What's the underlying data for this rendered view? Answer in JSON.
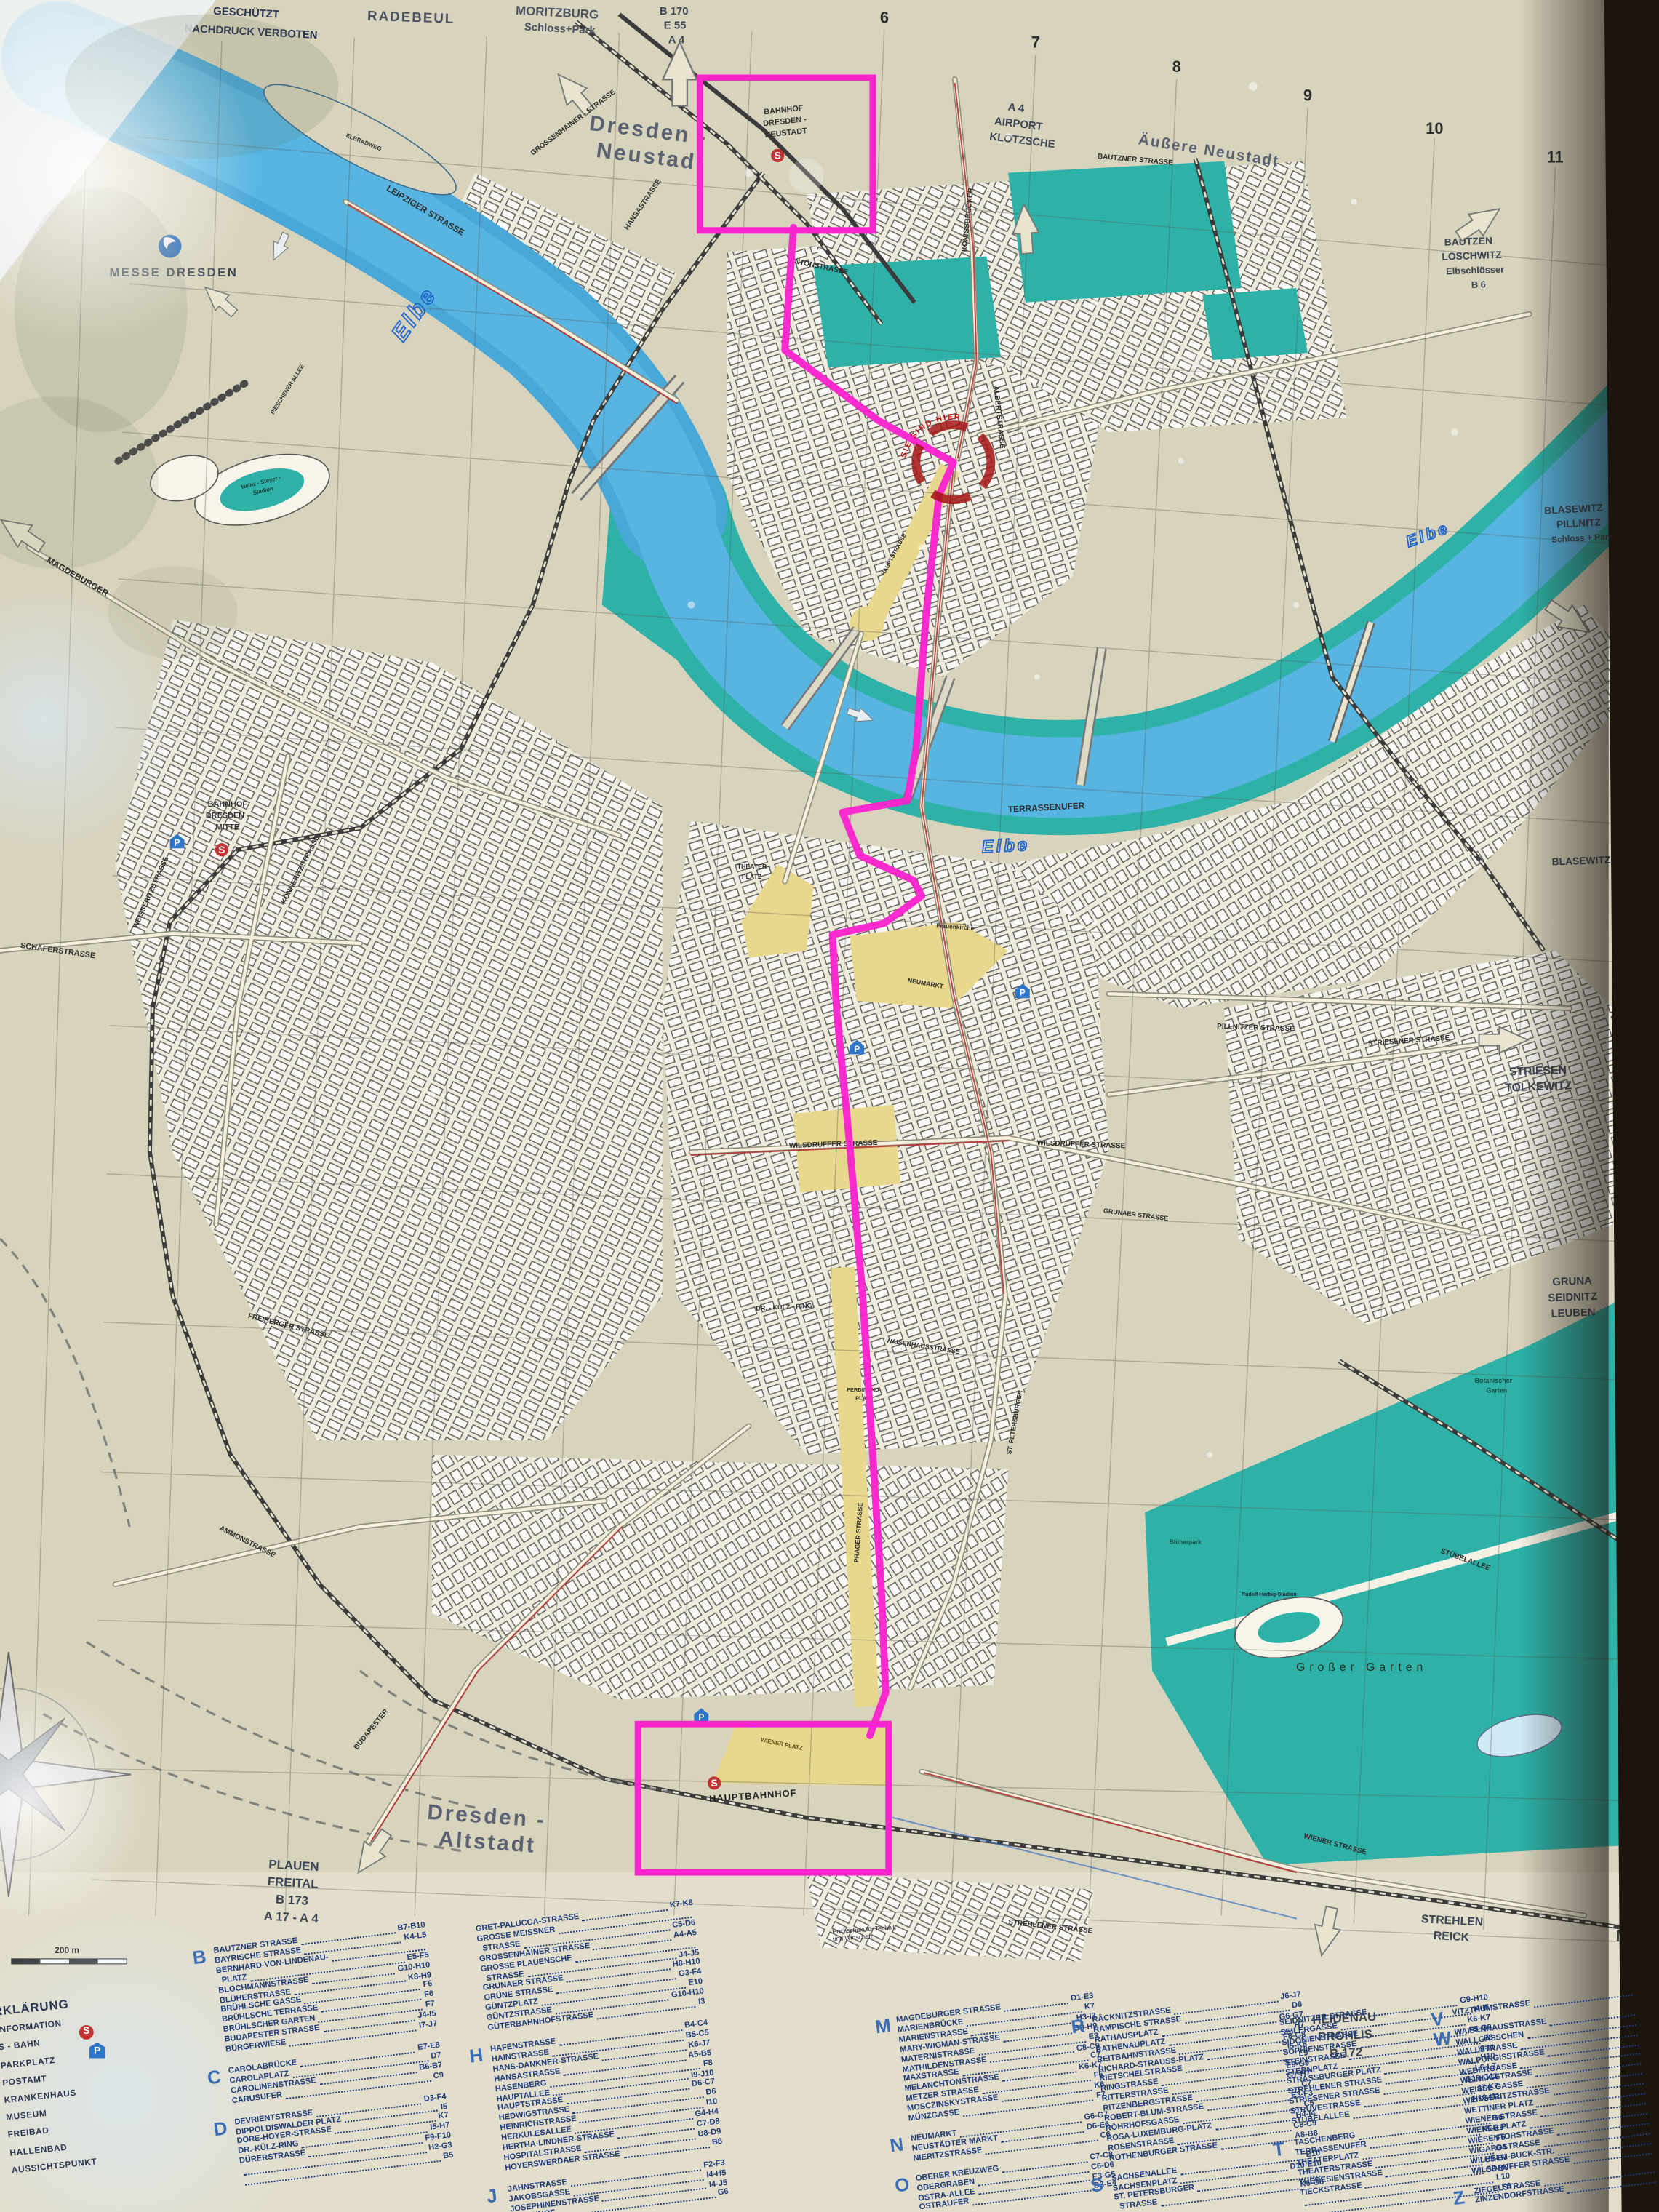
{
  "notice": {
    "line1": "GESCHÜTZT",
    "line2": "NACHDRUCK VERBOTEN"
  },
  "grid": {
    "cols": [
      "6",
      "7",
      "8",
      "9",
      "10",
      "11"
    ],
    "rows": [
      "A",
      "B",
      "C",
      "D",
      "E",
      "F",
      "G",
      "H",
      "I",
      "J",
      "K",
      "L",
      "M"
    ]
  },
  "edge": {
    "radebeul": "RADEBEUL",
    "moritzburg1": "MORITZBURG",
    "moritzburg2": "Schloss+Park",
    "b170": "B 170",
    "e55": "E 55",
    "a4": "A 4",
    "airport1": "A 4",
    "airport2": "AIRPORT",
    "airport3": "KLOTZSCHE",
    "bautzen1": "BAUTZEN",
    "bautzen2": "LOSCHWITZ",
    "bautzen3": "Elbschlösser",
    "bautzen4": "B 6",
    "blasewitz1": "BLASEWITZ",
    "blasewitz2": "PILLNITZ",
    "blasewitz3": "Schloss + Park",
    "blasewitz_single": "BLASEWITZ",
    "striesen1": "STRIESEN",
    "striesen2": "TOLKEWITZ",
    "gruna1": "GRUNA",
    "gruna2": "SEIDNITZ",
    "gruna3": "LEUBEN",
    "strehlen1": "STREHLEN",
    "strehlen2": "REICK",
    "heidenau1": "HEIDENAU",
    "heidenau2": "PROHLIS",
    "heidenau3": "B 172",
    "plauen1": "PLAUEN",
    "plauen2": "FREITAL",
    "plauen3": "B 173",
    "plauen4": "A 17 - A 4"
  },
  "districts": {
    "dresden_neustadt1": "Dresden -",
    "dresden_neustadt2": "Neustadt",
    "aeussere_neustadt": "Äußere Neustadt",
    "dresden_altstadt1": "Dresden -",
    "dresden_altstadt2": "Altstadt"
  },
  "stations": {
    "neustadt1": "BAHNHOF",
    "neustadt2": "DRESDEN -",
    "neustadt3": "NEUSTADT",
    "mitte1": "BAHNHOF",
    "mitte2": "DRESDEN -",
    "mitte3": "MITTE",
    "hbf": "HAUPTBAHNHOF",
    "s": "S",
    "p": "P"
  },
  "landmarks": {
    "messe": "MESSE DRESDEN",
    "heinz1": "Heinz - Steyer -",
    "heinz2": "Stadion",
    "grosser_garten": "Großer   Garten",
    "botanischer1": "Botanischer",
    "botanischer2": "Garten",
    "bluherpark": "Blüherpark",
    "harbig": "Rudolf-Harbig-Stadion",
    "frauenkirche": "Frauenkirche",
    "theaterplatz1": "THEATER -",
    "theaterplatz2": "PLATZ",
    "neumarkt": "NEUMARKT",
    "wiener_platz": "WIENER  PLATZ",
    "ferdinand1": "FERDINAND-",
    "ferdinand2": "PLATZ",
    "sie_sind_hier": "SIE SIND HIER"
  },
  "hochschule": {
    "line1": "Hochschule für Technik",
    "line2": "und Wirtschaft"
  },
  "river": {
    "elbe": "Elbe"
  },
  "streets": {
    "leipziger": "LEIPZIGER  STRASSE",
    "grossenhainer": "GROSSENHAINER - STRASSE",
    "hansastrasse": "HANSASTRASSE",
    "koenigsbruecker": "KÖNIGSBRÜCKER",
    "antonstrasse": "ANTONSTRASSE",
    "bautzner": "BAUTZNER  STRASSE",
    "albertstrasse": "ALBERTSTRASSE",
    "terrassenufer": "TERRASSENUFER",
    "wilsdruffer": "WILSDRUFFER  STRASSE",
    "dr_kuelz": "DR. - KÜLZ - RING",
    "waisenhaus": "WAISENHAUSSTRASSE",
    "pillnitzer": "PILLNITZER  STRASSE",
    "striesener": "STRIESENER  STRASSE",
    "stuebelallee": "STÜBELALLEE",
    "wiener": "WIENER  STRASSE",
    "strehlener": "STREHLENER  STRASSE",
    "budapester": "BUDAPESTER",
    "magdeburger": "MAGDEBURGER",
    "schaefer": "SCHÄFERSTRASSE",
    "weisseritz": "WEISSERITZSTRASSE",
    "koenneritz": "KÖNNERITZSTRASSE",
    "ammon": "AMMONSTRASSE",
    "freiberger": "FREIBERGER  STRASSE",
    "elbradweg": "ELBRADWEG",
    "pieschener": "PIESCHENER  ALLEE",
    "st_petersburger": "ST. PETERSBURGER",
    "prager": "PRAGER  STRASSE",
    "hauptstrasse": "HAUPTSTRASSE",
    "grunaer": "GRUNAER  STRASSE"
  },
  "scale_label": "200 m",
  "legend": {
    "title": "ZEICHENERKLÄRUNG",
    "items": [
      {
        "label": "INFORMATION"
      },
      {
        "label": "S - BAHN"
      },
      {
        "label": "PARKPLATZ"
      },
      {
        "label": "POSTAMT"
      },
      {
        "label": "KRANKENHAUS"
      },
      {
        "label": "MUSEUM"
      },
      {
        "label": "FREIBAD"
      },
      {
        "label": "HALLENBAD"
      },
      {
        "label": "AUSSICHTSPUNKT"
      }
    ]
  },
  "index": {
    "b": {
      "letter": "B",
      "entries": [
        {
          "name": "BAUTZNER STRASSE",
          "ref": "B7-B10"
        },
        {
          "name": "BAYRISCHE STRASSE",
          "ref": "K4-L5"
        },
        {
          "name": "BERNHARD-VON-LINDENAU-",
          "ref": ""
        },
        {
          "name": "  PLATZ",
          "ref": "E5-F5"
        },
        {
          "name": "BLOCHMANNSTRASSE",
          "ref": "G10-H10"
        },
        {
          "name": "BLÜHERSTRASSE",
          "ref": "K8-H9"
        },
        {
          "name": "BRÜHLSCHE GASSE",
          "ref": "F6"
        },
        {
          "name": "BRÜHLSCHE TERRASSE",
          "ref": "F6"
        },
        {
          "name": "BRÜHLSCHER GARTEN",
          "ref": "F7"
        },
        {
          "name": "BUDAPESTER STRASSE",
          "ref": "J4-I5"
        },
        {
          "name": "BÜRGERWIESE",
          "ref": "I7-J7"
        }
      ]
    },
    "c": {
      "letter": "C",
      "entries": [
        {
          "name": "CAROLABRÜCKE",
          "ref": "E7-E8"
        },
        {
          "name": "CAROLAPLATZ",
          "ref": "D7"
        },
        {
          "name": "CAROLINENSTRASSE",
          "ref": "B6-B7"
        },
        {
          "name": "CARUSUFER",
          "ref": "C9"
        }
      ]
    },
    "d": {
      "letter": "D",
      "entries": [
        {
          "name": "DEVRIENTSTRASSE",
          "ref": "D3-F4"
        },
        {
          "name": "DIPPOLDISWALDER PLATZ",
          "ref": "I5"
        },
        {
          "name": "DORE-HOYER-STRASSE",
          "ref": "K7"
        },
        {
          "name": "DR.-KÜLZ-RING",
          "ref": "I5-H7"
        },
        {
          "name": "DÜRERSTRASSE",
          "ref": "F9-F10"
        },
        {
          "name": "",
          "ref": "H2-G3"
        },
        {
          "name": "",
          "ref": "B5"
        }
      ]
    },
    "g": {
      "letter": "",
      "entries": [
        {
          "name": "GRET-PALUCCA-STRASSE",
          "ref": "K7-K8"
        },
        {
          "name": "GROSSE MEISSNER",
          "ref": ""
        },
        {
          "name": "  STRASSE",
          "ref": "C5-D6"
        },
        {
          "name": "GROSSENHAINER STRASSE",
          "ref": "A4-A5"
        },
        {
          "name": "GROSSE PLAUENSCHE",
          "ref": ""
        },
        {
          "name": "  STRASSE",
          "ref": "J4-J5"
        },
        {
          "name": "GRUNAER STRASSE",
          "ref": "H8-H10"
        },
        {
          "name": "GRÜNE STRASSE",
          "ref": "G3-F4"
        },
        {
          "name": "GÜNTZPLATZ",
          "ref": "E10"
        },
        {
          "name": "GÜNTZSTRASSE",
          "ref": "G10-H10"
        },
        {
          "name": "GÜTERBAHNHOFSTRASSE",
          "ref": "I3"
        }
      ]
    },
    "h": {
      "letter": "H",
      "entries": [
        {
          "name": "HAFENSTRASSE",
          "ref": "B4-C4"
        },
        {
          "name": "HAINSTRASSE",
          "ref": "B5-C5"
        },
        {
          "name": "HANS-DANKNER-STRASSE",
          "ref": "K6-J7"
        },
        {
          "name": "HANSASTRASSE",
          "ref": "A5-B5"
        },
        {
          "name": "HASENBERG",
          "ref": "F8"
        },
        {
          "name": "HAUPTALLEE",
          "ref": "I9-J10"
        },
        {
          "name": "HAUPTSTRASSE",
          "ref": "D6-C7"
        },
        {
          "name": "HEDWIGSTRASSE",
          "ref": "D6"
        },
        {
          "name": "HEINRICHSTRASSE",
          "ref": "I10"
        },
        {
          "name": "HERKULESALLEE",
          "ref": "G4-H4"
        },
        {
          "name": "HERTHA-LINDNER-STRASSE",
          "ref": "C7-D8"
        },
        {
          "name": "HOSPITALSTRASSE",
          "ref": "B8-D9"
        },
        {
          "name": "HOYERSWERDAER STRASSE",
          "ref": "B8"
        }
      ]
    },
    "j": {
      "letter": "J",
      "entries": [
        {
          "name": "JAHNSTRASSE",
          "ref": "F2-F3"
        },
        {
          "name": "JAKOBSGASSE",
          "ref": "I4-H5"
        },
        {
          "name": "JOSEPHINENSTRASSE",
          "ref": "I4-J5"
        },
        {
          "name": "JÜDENHOF",
          "ref": "G6"
        }
      ]
    },
    "m": {
      "letter": "M",
      "entries": [
        {
          "name": "MAGDEBURGER STRASSE",
          "ref": "D1-E3"
        },
        {
          "name": "MARIENBRÜCKE",
          "ref": "K7"
        },
        {
          "name": "MARIENSTRASSE",
          "ref": "H3-I3"
        },
        {
          "name": "MARY-WIGMAN-STRASSE",
          "ref": "G9-H9"
        },
        {
          "name": "MATERNISTRASSE",
          "ref": "E3"
        },
        {
          "name": "MATHILDENSTRASSE",
          "ref": "C8-C9"
        },
        {
          "name": "MAXSTRASSE",
          "ref": "C7"
        },
        {
          "name": "MELANCHTONSTRASSE",
          "ref": "K6-K7"
        },
        {
          "name": "METZER STRASSE",
          "ref": "F6"
        },
        {
          "name": "MOSCZINSKYSTRASSE",
          "ref": "K6"
        },
        {
          "name": "MÜNZGASSE",
          "ref": "F7"
        }
      ]
    },
    "n": {
      "letter": "N",
      "entries": [
        {
          "name": "NEUMARKT",
          "ref": "G6-G7"
        },
        {
          "name": "NEUSTÄDTER MARKT",
          "ref": "D6-E6"
        },
        {
          "name": "NIERITZSTRASSE",
          "ref": "C6"
        }
      ]
    },
    "o": {
      "letter": "O",
      "entries": [
        {
          "name": "OBERER KREUZWEG",
          "ref": "C7-C8"
        },
        {
          "name": "OBERGRABEN",
          "ref": "C6-D6"
        },
        {
          "name": "OSTRA-ALLEE",
          "ref": "E3-G5"
        },
        {
          "name": "OSTRAUFER",
          "ref": "D3-E4"
        }
      ]
    },
    "r": {
      "letter": "R",
      "entries": [
        {
          "name": "RÄCKNITZSTRASSE",
          "ref": "J6-J7"
        },
        {
          "name": "RAMPISCHE STRASSE",
          "ref": "D6"
        },
        {
          "name": "RATHAUSPLATZ",
          "ref": "G6-G7"
        },
        {
          "name": "RATHENAUPLATZ",
          "ref": "H7"
        },
        {
          "name": "REITBAHNSTRASSE",
          "ref": "F8-G8"
        },
        {
          "name": "RICHARD-STRAUSS-PLATZ",
          "ref": "I5-K5"
        },
        {
          "name": "RIETSCHELSTRASSE",
          "ref": "L9"
        },
        {
          "name": "RINGSTRASSE",
          "ref": "E9-G9"
        },
        {
          "name": "RITTERSTRASSE",
          "ref": "G7-H7"
        },
        {
          "name": "RITZENBERGSTRASSE",
          "ref": "C7"
        },
        {
          "name": "ROBERT-BLUM-STRASSE",
          "ref": "E3-F3"
        },
        {
          "name": "RÖHRHOFSGASSE",
          "ref": "C5"
        },
        {
          "name": "ROSA-LUXEMBURG-PLATZ",
          "ref": "H4-I4"
        },
        {
          "name": "ROSENSTRASSE",
          "ref": "C8-C9"
        },
        {
          "name": "ROTHENBURGER STRASSE",
          "ref": "A8-B8"
        }
      ]
    },
    "s": {
      "letter": "S",
      "entries": [
        {
          "name": "SACHSENALLEE",
          "ref": "E10"
        },
        {
          "name": "SACHSENPLATZ",
          "ref": "D10-E10"
        },
        {
          "name": "ST. PETERSBURGER",
          "ref": ""
        },
        {
          "name": "  STRASSE",
          "ref": "K6-G8"
        }
      ]
    },
    "s2": {
      "letter": "",
      "entries": [
        {
          "name": "SEIDNITZER STRASSE",
          "ref": "G9-H10"
        },
        {
          "name": "SEILERGASSE",
          "ref": "I4-I5"
        },
        {
          "name": "SIDONIENSTRASSE",
          "ref": "K6-K7"
        },
        {
          "name": "SOPHIENSTRASSE",
          "ref": "F5-G5"
        },
        {
          "name": "STEINSTRASSE",
          "ref": "F8"
        },
        {
          "name": "STERNPLATZ",
          "ref": "I3-I4"
        },
        {
          "name": "STRASSBURGER PLATZ",
          "ref": "H10"
        },
        {
          "name": "STREHLENER STRASSE",
          "ref": "L6-L7"
        },
        {
          "name": "STRIESENER STRASSE",
          "ref": "G10-G11"
        },
        {
          "name": "STRUVESTRASSE",
          "ref": "J7-K7"
        },
        {
          "name": "STÜBELALLEE",
          "ref": "H10-I11"
        }
      ]
    },
    "t": {
      "letter": "T",
      "entries": [
        {
          "name": "TASCHENBERG",
          "ref": "G6"
        },
        {
          "name": "TERRASSENUFER",
          "ref": "F5-E9"
        },
        {
          "name": "THEATERPLATZ",
          "ref": "F5"
        },
        {
          "name": "THEATERSTRASSE",
          "ref": "G4"
        },
        {
          "name": "THERESIENSTRASSE",
          "ref": "C5-B7"
        },
        {
          "name": "TIECKSTRASSE",
          "ref": "C8-B9"
        },
        {
          "name": "",
          "ref": "L10"
        },
        {
          "name": "",
          "ref": "F6"
        }
      ]
    },
    "v": {
      "letter": "V",
      "entries": [
        {
          "name": "VITZTHUMSTRASSE",
          "ref": ""
        }
      ]
    },
    "w": {
      "letter": "W",
      "entries": [
        {
          "name": "WAISENHAUSSTRASSE",
          "ref": ""
        },
        {
          "name": "WALLGÄSSCHEN",
          "ref": ""
        },
        {
          "name": "WALLSTRASSE",
          "ref": ""
        },
        {
          "name": "WALPURGISSTRASSE",
          "ref": ""
        },
        {
          "name": "WEBERGASSE",
          "ref": ""
        },
        {
          "name": "WEINLIGSTRASSE",
          "ref": ""
        },
        {
          "name": "WEISSE GASSE",
          "ref": ""
        },
        {
          "name": "WEISSERITZSTRASSE",
          "ref": ""
        },
        {
          "name": "WETTINER PLATZ",
          "ref": ""
        },
        {
          "name": "WIENER STRASSE",
          "ref": ""
        },
        {
          "name": "WIENER PLATZ",
          "ref": ""
        },
        {
          "name": "WIESENTORSTRASSE",
          "ref": ""
        },
        {
          "name": "WIGARDSTRASSE",
          "ref": ""
        },
        {
          "name": "WILHELM-BUCK-STR.",
          "ref": ""
        },
        {
          "name": "WILSDRUFFER STRASSE",
          "ref": ""
        }
      ]
    },
    "z": {
      "letter": "Z",
      "entries": [
        {
          "name": "ZIEGELSTRASSE",
          "ref": ""
        },
        {
          "name": "ZINZENDORFSTRASSE",
          "ref": ""
        }
      ]
    }
  }
}
